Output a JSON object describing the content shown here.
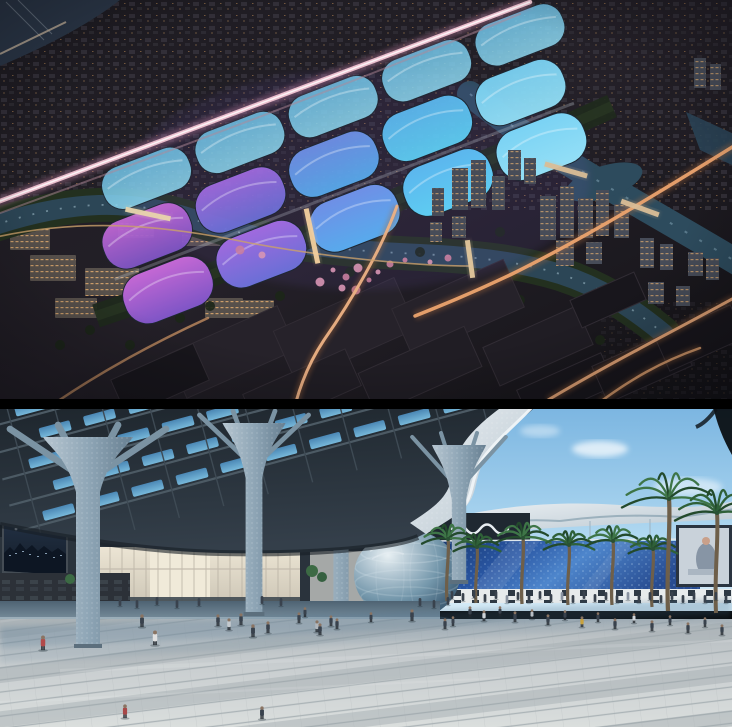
{
  "page": {
    "title": "Exhibition centre architectural renderings",
    "description": "Two stacked architectural renderings: a night aerial view of a riverside exhibition complex with glowing wave-shaped roofs, and a daytime plaza view under a sculptural canopy with a spherical pavilion and palm trees."
  },
  "panels": {
    "aerial": {
      "alt": "Night aerial rendering of exhibition centre with purple and cyan wave roofs, rivers, bridges and light-trail roads",
      "palette": {
        "night_base": "#201d24",
        "water": "#2c4656",
        "roof_magenta": "#c468d4",
        "roof_purple": "#7e55c6",
        "roof_blue": "#58aaec",
        "roof_cyan": "#5ecdf2",
        "trail_pink": "#f2c6d4",
        "trail_warm": "#eba36e",
        "blossom": "#d795b4"
      },
      "halls": {
        "origin": [
          168,
          290
        ],
        "rot": -21,
        "pillow_w": 92,
        "cols": [
          {
            "dx": 0,
            "c1": "#c468d4",
            "c2": "#7e55c6"
          },
          {
            "dx": 100,
            "c1": "#a06ade",
            "c2": "#6a6fd6"
          },
          {
            "dx": 200,
            "c1": "#6f8fe6",
            "c2": "#58aaec"
          },
          {
            "dx": 300,
            "c1": "#5cb6ee",
            "c2": "#5ecdf2"
          },
          {
            "dx": 400,
            "c1": "#7ad2f4",
            "c2": "#93dff6"
          }
        ],
        "rows": [
          {
            "dy": 0,
            "h": 52,
            "opacity": 1
          },
          {
            "dy": -58,
            "h": 50,
            "opacity": 0.95
          },
          {
            "dy": -112,
            "h": 44,
            "opacity": 0.85,
            "c1": "#6fc2e8",
            "c2": "#8ed8f0"
          }
        ]
      },
      "light_trails": [
        {
          "d": "M-8,204 C150,146 300,90 530,2",
          "color": "#f2c6d4",
          "w": 4.5,
          "glow": "#c884a8",
          "core": true
        },
        {
          "d": "M-8,216 C150,158 300,104 520,14",
          "color": "#b08898",
          "w": 2,
          "opacity": 0.5
        },
        {
          "d": "M734,146 C660,192 585,238 512,274 C470,294 440,306 415,316",
          "color": "#eba36e",
          "w": 3.5,
          "glow": "#aa6a3c"
        },
        {
          "d": "M734,298 C672,332 612,362 548,400",
          "color": "#e8a878",
          "w": 3,
          "glow": "#aa6a3c"
        },
        {
          "d": "M397,206 C382,248 352,300 324,340 C312,358 302,380 296,402",
          "color": "#ecb184",
          "w": 3,
          "glow": "#aa6a3c"
        },
        {
          "d": "M58,401 C110,366 160,340 208,318",
          "color": "#d59a68",
          "w": 2.5,
          "opacity": 0.7
        },
        {
          "d": "M-8,238 C80,218 160,224 250,243 C330,258 420,266 470,266",
          "color": "#caa06a",
          "w": 1.6,
          "opacity": 0.8
        },
        {
          "d": "M600,402 C630,380 660,362 700,348",
          "color": "#d89c6c",
          "w": 2.5,
          "glow": "#aa6a3c"
        }
      ],
      "bridges": [
        {
          "x": 148,
          "y": 214,
          "len": 46,
          "rot": 12,
          "color": "#e8d4ac"
        },
        {
          "x": 312,
          "y": 236,
          "len": 56,
          "rot": 78,
          "color": "#f2cf9e"
        },
        {
          "x": 470,
          "y": 259,
          "len": 38,
          "rot": 82,
          "color": "#e3c79c"
        },
        {
          "x": 566,
          "y": 170,
          "len": 44,
          "rot": 16,
          "color": "#d9bd96"
        },
        {
          "x": 640,
          "y": 208,
          "len": 40,
          "rot": 20,
          "color": "#d9bd96"
        }
      ],
      "towers": [
        {
          "x": 540,
          "y": 196,
          "w": 16,
          "h": 44
        },
        {
          "x": 560,
          "y": 186,
          "w": 14,
          "h": 52
        },
        {
          "x": 578,
          "y": 198,
          "w": 15,
          "h": 40
        },
        {
          "x": 596,
          "y": 190,
          "w": 13,
          "h": 46
        },
        {
          "x": 614,
          "y": 204,
          "w": 15,
          "h": 34
        },
        {
          "x": 556,
          "y": 240,
          "w": 18,
          "h": 26
        },
        {
          "x": 586,
          "y": 242,
          "w": 16,
          "h": 22
        },
        {
          "x": 640,
          "y": 238,
          "w": 14,
          "h": 30
        },
        {
          "x": 660,
          "y": 244,
          "w": 13,
          "h": 26
        },
        {
          "x": 688,
          "y": 252,
          "w": 15,
          "h": 24
        },
        {
          "x": 706,
          "y": 258,
          "w": 13,
          "h": 22
        },
        {
          "x": 648,
          "y": 282,
          "w": 16,
          "h": 22
        },
        {
          "x": 676,
          "y": 286,
          "w": 14,
          "h": 20
        },
        {
          "x": 452,
          "y": 168,
          "w": 16,
          "h": 42
        },
        {
          "x": 471,
          "y": 160,
          "w": 15,
          "h": 48
        },
        {
          "x": 432,
          "y": 188,
          "w": 12,
          "h": 28
        },
        {
          "x": 492,
          "y": 176,
          "w": 13,
          "h": 34
        },
        {
          "x": 694,
          "y": 58,
          "w": 12,
          "h": 30
        },
        {
          "x": 710,
          "y": 64,
          "w": 11,
          "h": 26
        },
        {
          "x": 452,
          "y": 216,
          "w": 14,
          "h": 22
        },
        {
          "x": 430,
          "y": 222,
          "w": 12,
          "h": 20
        },
        {
          "x": 508,
          "y": 150,
          "w": 13,
          "h": 30
        },
        {
          "x": 524,
          "y": 158,
          "w": 12,
          "h": 26
        }
      ],
      "lit_blocks": [
        {
          "x": 30,
          "y": 255,
          "w": 46,
          "h": 26
        },
        {
          "x": 85,
          "y": 268,
          "w": 54,
          "h": 28
        },
        {
          "x": 148,
          "y": 283,
          "w": 42,
          "h": 22
        },
        {
          "x": 55,
          "y": 298,
          "w": 42,
          "h": 20
        },
        {
          "x": 205,
          "y": 298,
          "w": 38,
          "h": 20
        },
        {
          "x": 10,
          "y": 228,
          "w": 40,
          "h": 22
        },
        {
          "x": 118,
          "y": 212,
          "w": 36,
          "h": 26
        },
        {
          "x": 182,
          "y": 222,
          "w": 44,
          "h": 24
        },
        {
          "x": 240,
          "y": 300,
          "w": 34,
          "h": 18
        }
      ],
      "warehouses": [
        {
          "x": 232,
          "y": 352,
          "w": 120,
          "h": 48,
          "s": 0
        },
        {
          "x": 345,
          "y": 330,
          "w": 132,
          "h": 56,
          "s": 0
        },
        {
          "x": 458,
          "y": 308,
          "w": 122,
          "h": 52,
          "s": 0
        },
        {
          "x": 302,
          "y": 390,
          "w": 112,
          "h": 40,
          "s": 1
        },
        {
          "x": 420,
          "y": 370,
          "w": 116,
          "h": 44,
          "s": 1
        },
        {
          "x": 538,
          "y": 346,
          "w": 102,
          "h": 42,
          "s": 1
        },
        {
          "x": 566,
          "y": 388,
          "w": 92,
          "h": 36,
          "s": 2
        },
        {
          "x": 642,
          "y": 366,
          "w": 92,
          "h": 40,
          "s": 2
        },
        {
          "x": 700,
          "y": 338,
          "w": 82,
          "h": 36,
          "s": 2
        },
        {
          "x": 160,
          "y": 380,
          "w": 90,
          "h": 40,
          "s": 2
        },
        {
          "x": 608,
          "y": 300,
          "w": 70,
          "h": 30,
          "s": 2
        }
      ],
      "blossoms": [
        [
          333,
          270
        ],
        [
          346,
          277
        ],
        [
          358,
          268
        ],
        [
          369,
          280
        ],
        [
          342,
          288
        ],
        [
          356,
          290
        ],
        [
          378,
          272
        ],
        [
          390,
          264
        ],
        [
          320,
          282
        ],
        [
          405,
          260
        ],
        [
          262,
          255
        ],
        [
          240,
          250
        ],
        [
          430,
          262
        ],
        [
          448,
          258
        ]
      ],
      "trees": [
        [
          180,
          318
        ],
        [
          210,
          306
        ],
        [
          280,
          296
        ],
        [
          350,
          272
        ],
        [
          420,
          252
        ],
        [
          500,
          232
        ],
        [
          90,
          330
        ],
        [
          60,
          345
        ],
        [
          130,
          345
        ],
        [
          520,
          300
        ],
        [
          600,
          340
        ]
      ]
    },
    "plaza": {
      "alt": "Daytime rendering of entrance plaza under tree-column canopy with spherical pavilion, blue glass facade, palm trees and pedestrians",
      "palette": {
        "sky_top": "#79b4e0",
        "canopy": "#242d35",
        "skylight": "#7ec4e8",
        "column": "#8fa6b6",
        "facade_blue": "#2a57a4",
        "sphere": "#7497ab",
        "plaza": "#c9ced0",
        "palm": "#2f6038"
      },
      "clouds": [
        {
          "x": 600,
          "y": 48,
          "rx": 28,
          "ry": 8,
          "o": 0.7
        },
        {
          "x": 688,
          "y": 86,
          "rx": 34,
          "ry": 9,
          "o": 0.5
        },
        {
          "x": 540,
          "y": 30,
          "rx": 20,
          "ry": 6,
          "o": 0.4
        }
      ],
      "far_towers": [
        {
          "x": 702,
          "y": 146,
          "w": 10,
          "h": 34
        },
        {
          "x": 714,
          "y": 152,
          "w": 8,
          "h": 28
        },
        {
          "x": 724,
          "y": 142,
          "w": 8,
          "h": 38
        }
      ],
      "columns": [
        {
          "x": 88,
          "top": 36,
          "bot": 246,
          "s": 1.5,
          "layer": "front"
        },
        {
          "x": 254,
          "top": 22,
          "bot": 214,
          "s": 1.05,
          "layer": "front"
        },
        {
          "x": 341,
          "top": 26,
          "bot": 203,
          "s": 0.95,
          "layer": "back"
        },
        {
          "x": 459,
          "top": 44,
          "bot": 182,
          "s": 0.9,
          "layer": "front"
        }
      ],
      "skylight_grid": {
        "rows": 5,
        "cols": 10,
        "w": 32,
        "h": 10,
        "gx": 46,
        "gy": 27,
        "rot": -15,
        "ox": 14,
        "oy": 6
      },
      "sphere": {
        "cx": 407,
        "cy": 174,
        "rx": 53,
        "ry": 45
      },
      "palms": [
        {
          "x": 447,
          "base": 200,
          "h": 62
        },
        {
          "x": 476,
          "base": 202,
          "h": 56
        },
        {
          "x": 522,
          "base": 203,
          "h": 66
        },
        {
          "x": 568,
          "base": 204,
          "h": 60
        },
        {
          "x": 612,
          "base": 204,
          "h": 64
        },
        {
          "x": 652,
          "base": 206,
          "h": 58
        },
        {
          "x": 668,
          "base": 210,
          "h": 112
        },
        {
          "x": 716,
          "base": 212,
          "h": 100
        }
      ],
      "people": [
        [
          120,
          205,
          8
        ],
        [
          137,
          207,
          8
        ],
        [
          157,
          204,
          8
        ],
        [
          177,
          207,
          8
        ],
        [
          199,
          205,
          8
        ],
        [
          262,
          203,
          8
        ],
        [
          281,
          205,
          8
        ],
        [
          420,
          205,
          8
        ],
        [
          434,
          207,
          8
        ],
        [
          448,
          204,
          8
        ],
        [
          452,
          198,
          8
        ],
        [
          463,
          200,
          8
        ],
        [
          474,
          197,
          8
        ],
        [
          485,
          201,
          8
        ],
        [
          496,
          198,
          8
        ],
        [
          507,
          202,
          8,
          "#8a93a0"
        ],
        [
          518,
          199,
          8
        ],
        [
          529,
          202,
          8
        ],
        [
          540,
          198,
          8
        ],
        [
          551,
          201,
          8
        ],
        [
          562,
          199,
          8,
          "#8a93a0"
        ],
        [
          573,
          202,
          8
        ],
        [
          584,
          198,
          8
        ],
        [
          595,
          201,
          8
        ],
        [
          606,
          199,
          8
        ],
        [
          617,
          202,
          8
        ],
        [
          628,
          199,
          8,
          "#8a93a0"
        ],
        [
          639,
          202,
          8
        ],
        [
          650,
          199,
          8
        ],
        [
          661,
          202,
          8
        ],
        [
          672,
          199,
          8
        ],
        [
          683,
          202,
          8
        ],
        [
          694,
          199,
          8
        ],
        [
          705,
          202,
          8
        ],
        [
          716,
          199,
          8
        ],
        [
          726,
          202,
          8
        ],
        [
          470,
          216,
          11
        ],
        [
          484,
          220,
          11,
          "#cfd4d8"
        ],
        [
          500,
          215,
          10
        ],
        [
          515,
          221,
          11
        ],
        [
          532,
          218,
          10,
          "#b8bec4"
        ],
        [
          548,
          224,
          11
        ],
        [
          565,
          219,
          10
        ],
        [
          582,
          226,
          11,
          "#c8a23e"
        ],
        [
          598,
          221,
          10
        ],
        [
          615,
          228,
          11
        ],
        [
          634,
          222,
          10,
          "#d0d5da"
        ],
        [
          652,
          230,
          11
        ],
        [
          670,
          224,
          10
        ],
        [
          688,
          232,
          11
        ],
        [
          705,
          226,
          10
        ],
        [
          722,
          234,
          11
        ],
        [
          218,
          225,
          12
        ],
        [
          229,
          229,
          12,
          "#c4c9ce"
        ],
        [
          241,
          224,
          12
        ],
        [
          253,
          236,
          13
        ],
        [
          268,
          232,
          12
        ],
        [
          299,
          222,
          11
        ],
        [
          317,
          231,
          12,
          "#b0b6bc"
        ],
        [
          331,
          225,
          11
        ],
        [
          305,
          216,
          10
        ],
        [
          320,
          234,
          12
        ],
        [
          337,
          228,
          11
        ],
        [
          371,
          221,
          10
        ],
        [
          445,
          228,
          11
        ],
        [
          453,
          225,
          10
        ],
        [
          412,
          220,
          12
        ],
        [
          142,
          226,
          13
        ],
        [
          43,
          249,
          15,
          "#b24a4a"
        ],
        [
          155,
          244,
          15,
          "#e0e0e0"
        ],
        [
          125,
          317,
          14,
          "#a84848"
        ],
        [
          262,
          318,
          13
        ]
      ]
    }
  }
}
